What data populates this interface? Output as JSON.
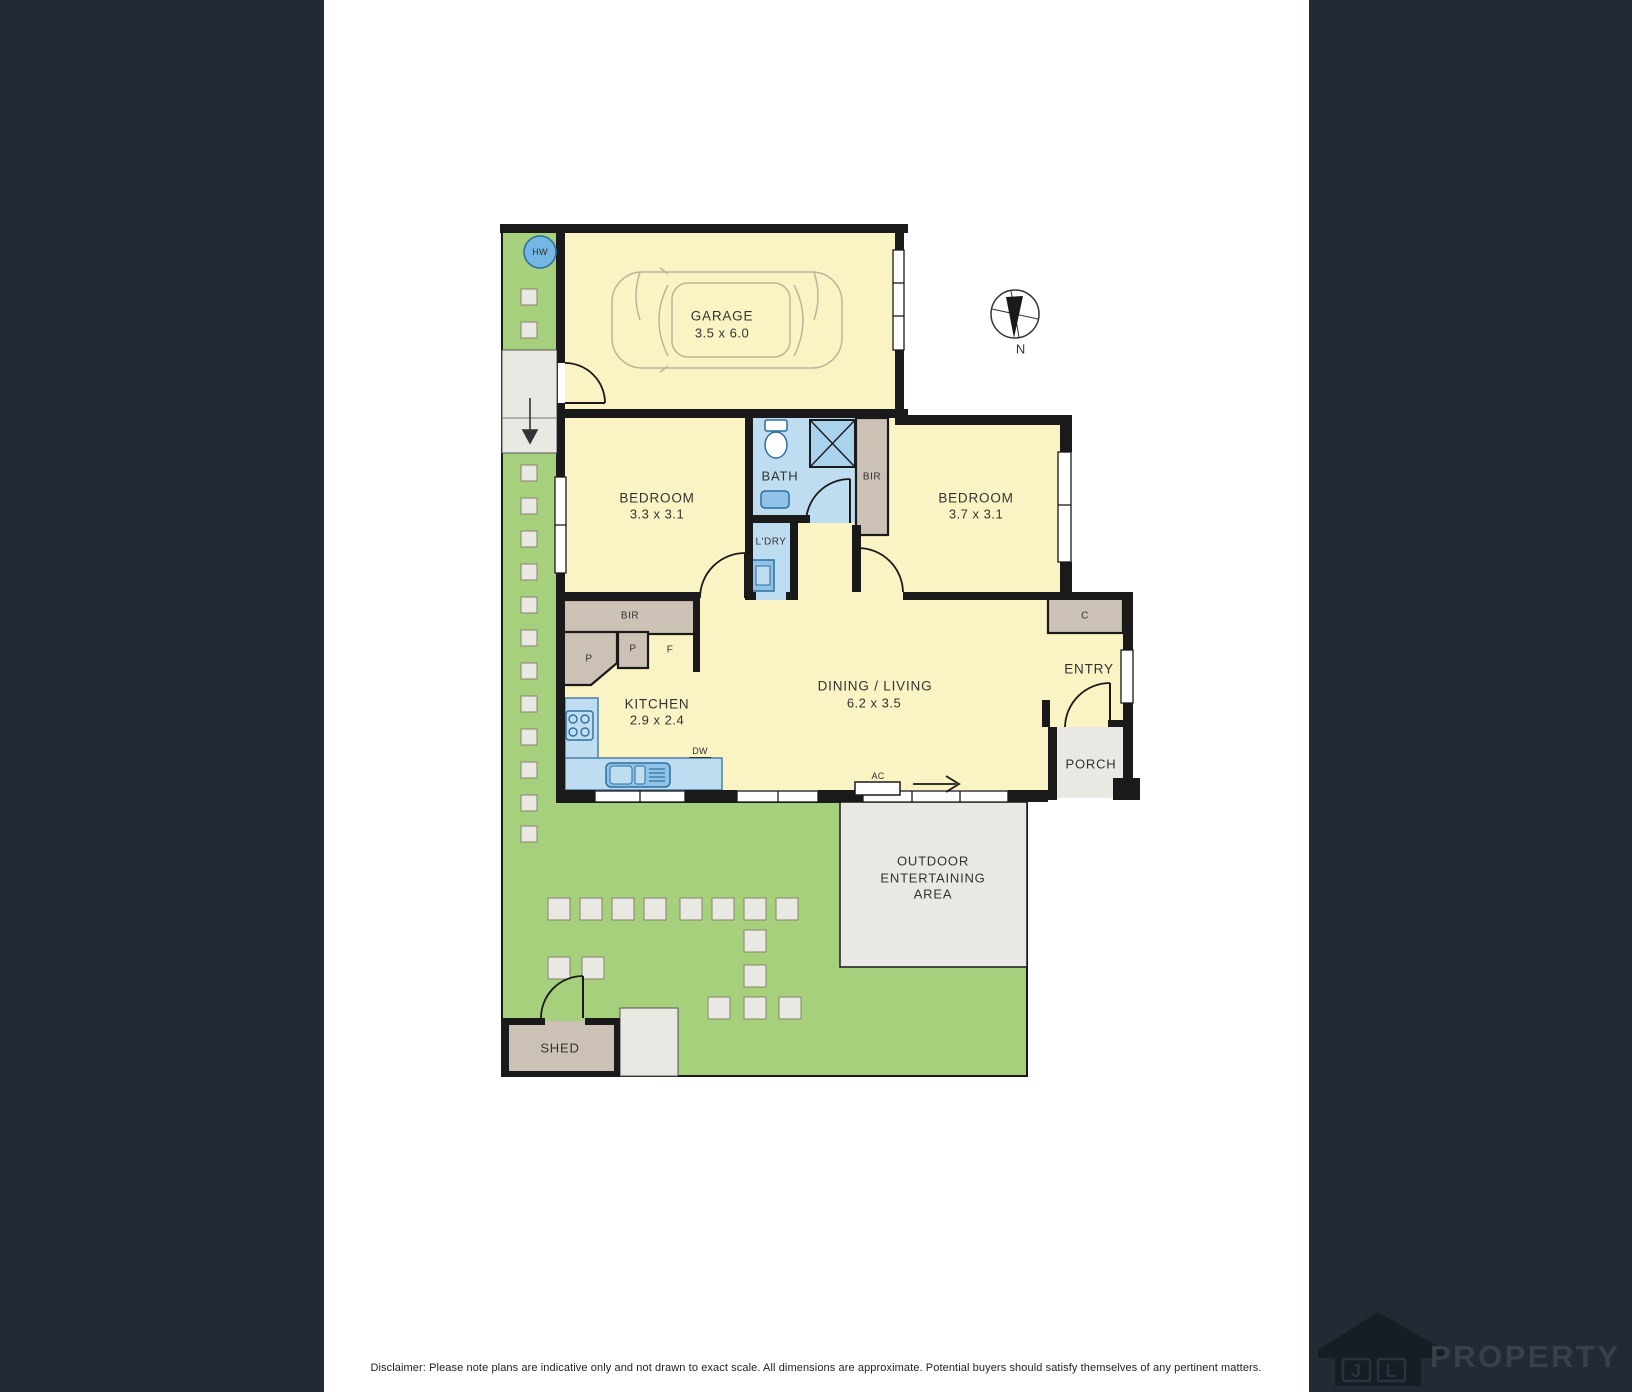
{
  "plan": {
    "garage": {
      "name": "GARAGE",
      "dims": "3.5 x 6.0"
    },
    "bedroom_left": {
      "name": "BEDROOM",
      "dims": "3.3 x 3.1"
    },
    "bedroom_right": {
      "name": "BEDROOM",
      "dims": "3.7 x 3.1"
    },
    "bath": {
      "name": "BATH"
    },
    "laundry": {
      "name": "L'DRY"
    },
    "kitchen": {
      "name": "KITCHEN",
      "dims": "2.9 x 2.4"
    },
    "dining_living": {
      "name": "DINING / LIVING",
      "dims": "6.2 x 3.5"
    },
    "entry": {
      "name": "ENTRY"
    },
    "porch": {
      "name": "PORCH"
    },
    "outdoor_area": {
      "line1": "OUTDOOR",
      "line2": "ENTERTAINING",
      "line3": "AREA"
    },
    "shed": {
      "name": "SHED"
    },
    "labels": {
      "bir_bath": "BIR",
      "bir_hall": "BIR",
      "cupboard": "C",
      "pantry_large": "P",
      "pantry_small": "P",
      "fridge": "F",
      "hot_water": "HW",
      "dishwasher": "DW",
      "air_conditioner": "AC"
    },
    "compass": {
      "north": "N"
    }
  },
  "footer": {
    "disclaimer": "Disclaimer: Please note plans are indicative only and not drawn to exact scale. All dimensions are approximate. Potential buyers should satisfy themselves of any pertinent matters."
  },
  "brand": {
    "j": "J",
    "l": "L",
    "name": "PROPERTY"
  },
  "colors": {
    "wall": "#1a1a1a",
    "room_fill": "#faf3c4",
    "wet_area_fill": "#bfddf0",
    "fixture_blue": "#8fc3e8",
    "garden_green": "#a6d07c",
    "robe_taupe": "#ccc1b5",
    "paving_grey": "#e9e8e2",
    "hot_water_blue": "#74b6e4",
    "band_navy": "#232a33"
  }
}
